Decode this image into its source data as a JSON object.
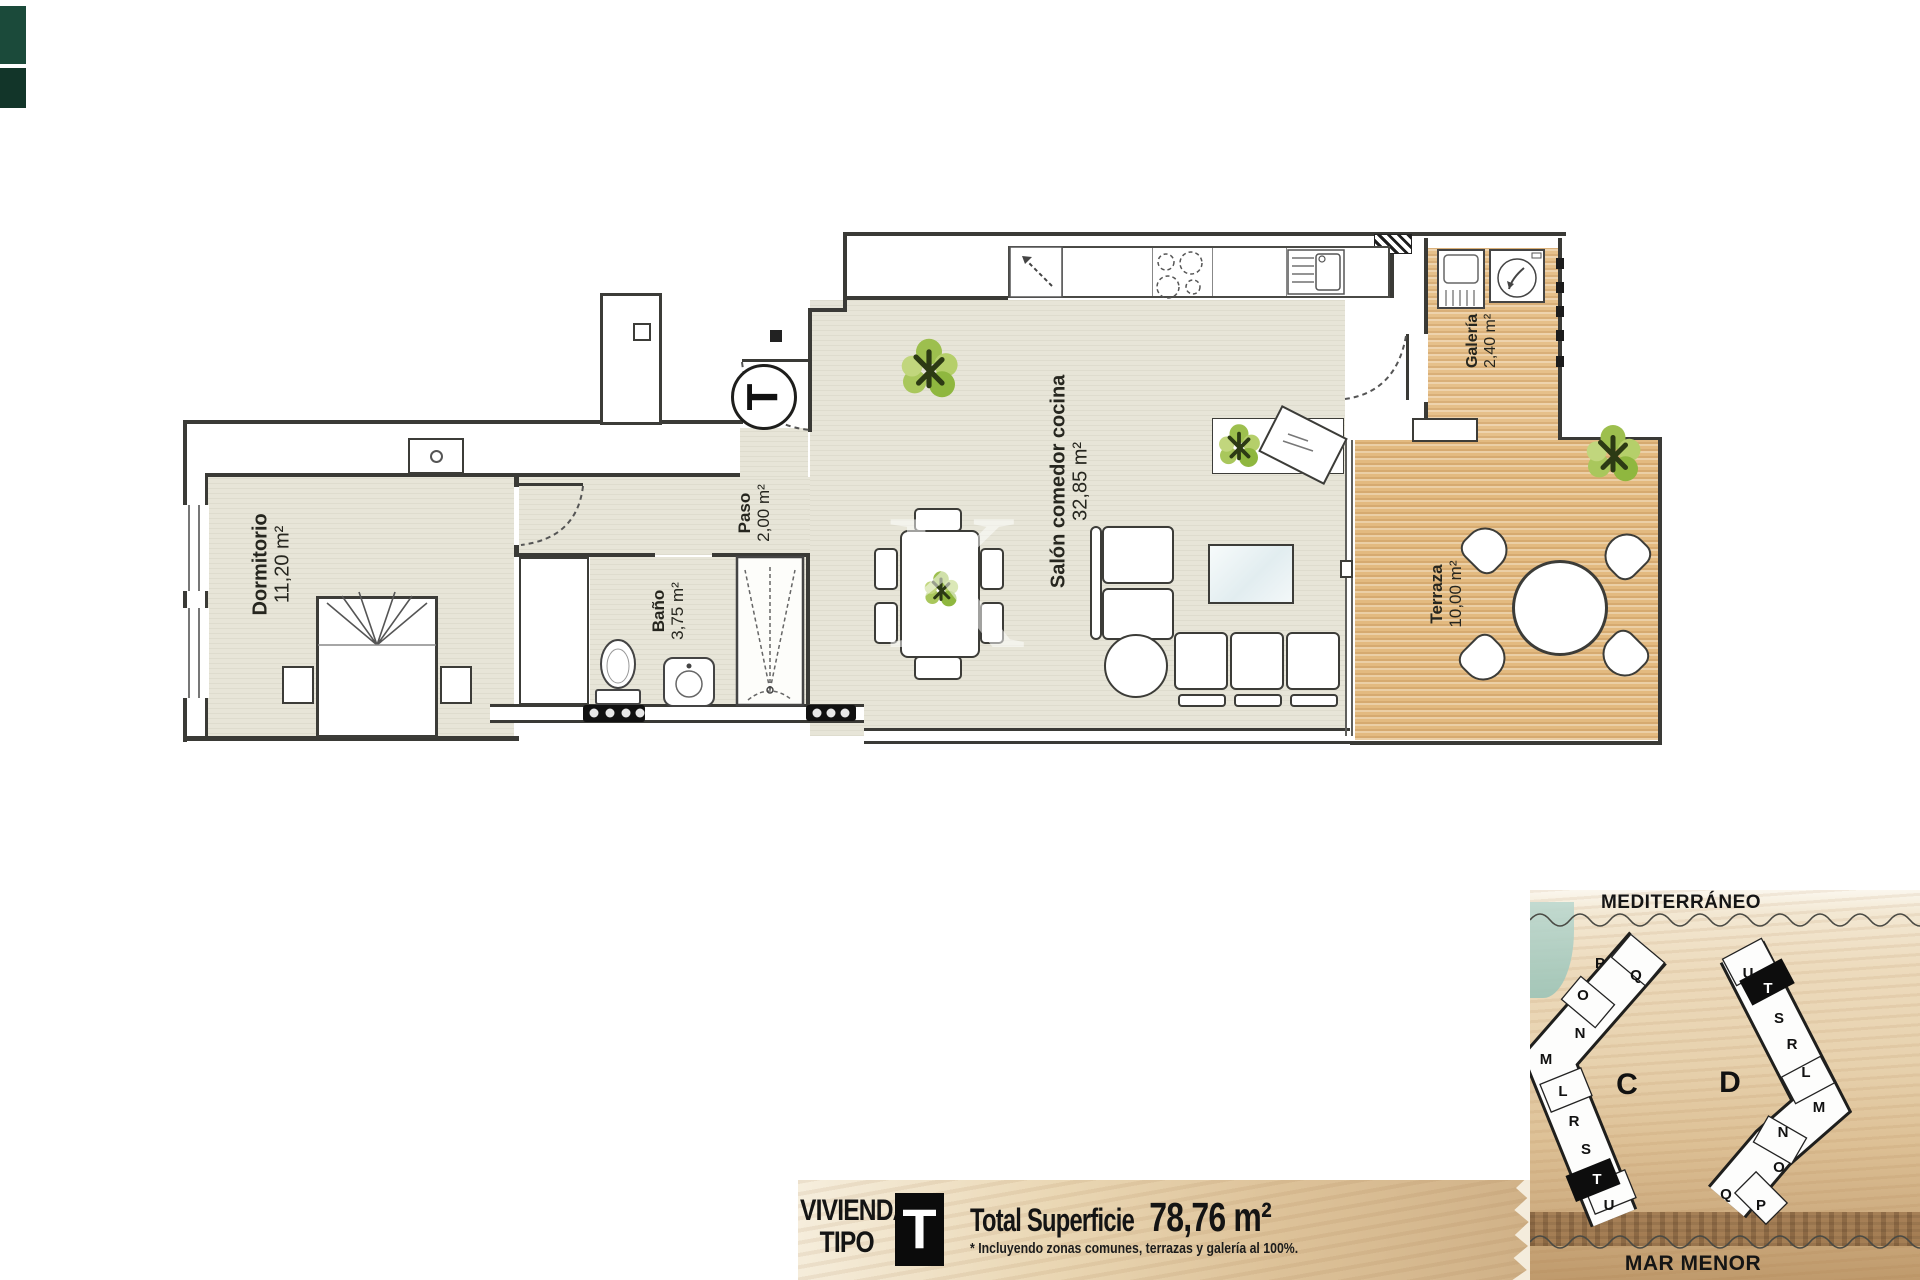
{
  "plan": {
    "entry_marker": "T",
    "watermark_letter": "K",
    "rooms": [
      {
        "key": "dormitorio",
        "label": "Dormitorio",
        "area": "11,20 m²"
      },
      {
        "key": "paso",
        "label": "Paso",
        "area": "2,00 m²"
      },
      {
        "key": "bano",
        "label": "Baño",
        "area": "3,75 m²"
      },
      {
        "key": "salon",
        "label": "Salón comedor cocina",
        "area": "32,85 m²"
      },
      {
        "key": "galeria",
        "label": "Galería",
        "area": "2,40 m²"
      },
      {
        "key": "terraza",
        "label": "Terraza",
        "area": "10,00 m²"
      }
    ]
  },
  "summary_bar": {
    "dwelling_word": "VIVIENDA",
    "type_word": "TIPO",
    "type_letter": "T",
    "total_label": "Total Superficie",
    "total_value": "78,76 m²",
    "footnote": "* Incluyendo zonas comunes, terrazas y galería al 100%."
  },
  "site_map": {
    "top_sea_label": "MEDITERRÁNEO",
    "bottom_sea_label": "MAR MENOR",
    "building_c": {
      "label": "C",
      "highlighted_unit": "T",
      "units": [
        "P",
        "Q",
        "O",
        "N",
        "M",
        "L",
        "R",
        "S",
        "T",
        "U"
      ]
    },
    "building_d": {
      "label": "D",
      "highlighted_unit": "T",
      "units": [
        "U",
        "T",
        "S",
        "R",
        "L",
        "M",
        "N",
        "O",
        "Q",
        "P"
      ]
    }
  },
  "colors": {
    "floor": "#e7e5d8",
    "wood": "#e6c08a",
    "wall": "#3a3a36",
    "sand": "#e7d1ad",
    "sea": "#9cc4b7",
    "highlight": "#0d0d0d"
  }
}
